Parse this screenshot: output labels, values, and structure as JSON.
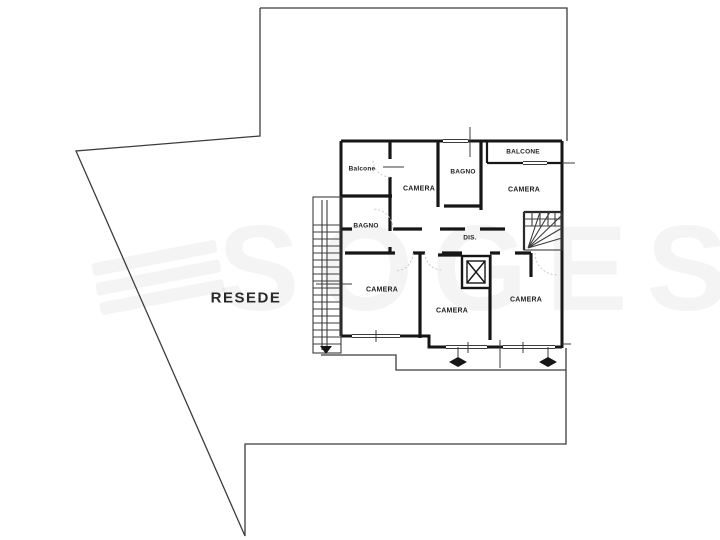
{
  "watermark": {
    "text": "SOGES"
  },
  "area_label": "RESEDE",
  "rooms": [
    {
      "name": "balcone-top-left",
      "label": "Balcone"
    },
    {
      "name": "camera-top-left",
      "label": "CAMERA"
    },
    {
      "name": "bagno-top",
      "label": "BAGNO"
    },
    {
      "name": "balcone-top-right",
      "label": "BALCONE"
    },
    {
      "name": "camera-top-right",
      "label": "CAMERA"
    },
    {
      "name": "bagno-left",
      "label": "BAGNO"
    },
    {
      "name": "disimpegno",
      "label": "DIS."
    },
    {
      "name": "camera-bottom-left",
      "label": "CAMERA"
    },
    {
      "name": "camera-bottom-center",
      "label": "CAMERA"
    },
    {
      "name": "camera-bottom-right",
      "label": "CAMERA"
    }
  ],
  "colors": {
    "ink": "#3c3c3c",
    "wall": "#161616",
    "watermark": "rgba(31,31,31,0.05)",
    "background": "#ffffff"
  }
}
